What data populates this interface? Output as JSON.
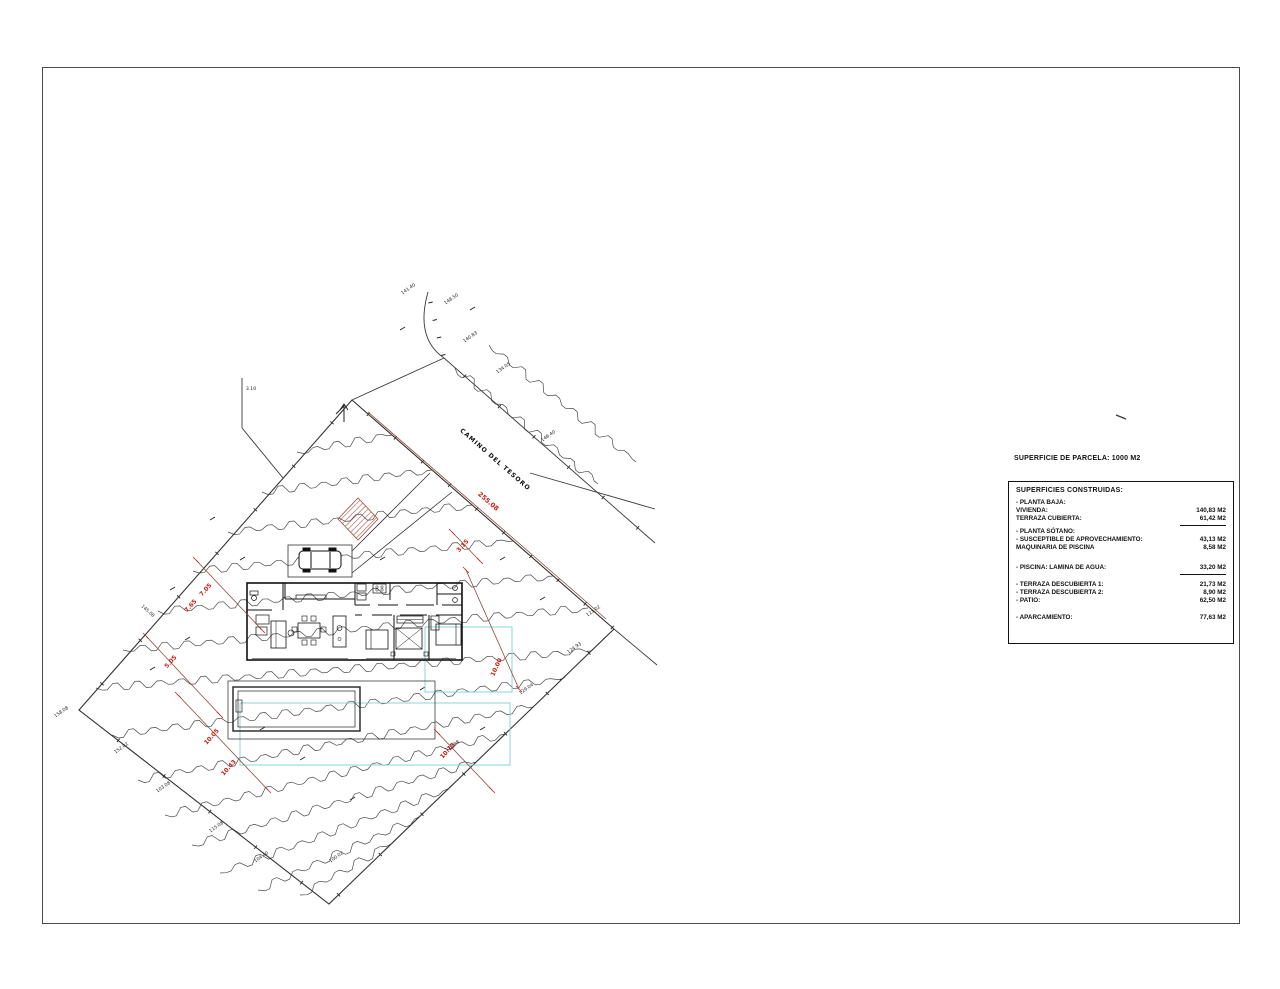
{
  "sheet": {
    "parcel_title": "SUPERFICIE DE PARCELA: 1000 M2",
    "table": {
      "heading": "SUPERFICIES CONSTRUIDAS:",
      "rows": [
        {
          "label": "- PLANTA BAJA:",
          "value": ""
        },
        {
          "label": "VIVIENDA:",
          "value": "140,83 M2"
        },
        {
          "label": "TERRAZA CUBIERTA:",
          "value": "61,42 M2"
        },
        {
          "label": "- PLANTA SÓTANO:",
          "value": ""
        },
        {
          "label": "- SUSCEPTIBLE DE APROVECHAMIENTO:",
          "value": "43,13 M2"
        },
        {
          "label": "MAQUINARIA DE PISCINA",
          "value": "8,58 M2"
        },
        {
          "label": "- PISCINA: LAMINA DE AGUA:",
          "value": "33,20 M2"
        },
        {
          "label": "- TERRAZA DESCUBIERTA 1:",
          "value": "21,73 M2"
        },
        {
          "label": "- TERRAZA DESCUBIERTA 2:",
          "value": "8,90 M2"
        },
        {
          "label": "- PATIO:",
          "value": "62,50 M2"
        },
        {
          "label": "- APARCAMIENTO:",
          "value": "77,63 M2"
        }
      ]
    }
  },
  "plan": {
    "road_label": "CAMINO DEL TESORO",
    "road_dimension": "255.08",
    "red_dimensions": [
      "7.65",
      "7.05",
      "5.05",
      "10.05",
      "10.43",
      "3.15",
      "10.00",
      "10.13"
    ],
    "survey_labels": [
      "141.40",
      "148.50",
      "140.83",
      "134.05",
      "146.40",
      "121.02",
      "124.93",
      "129.04",
      "128.88",
      "158.08",
      "152.02",
      "103.08",
      "115.08",
      "104.40",
      "100.02",
      "145.08",
      "3.10"
    ],
    "colors": {
      "line": "#3a3a3a",
      "red_text": "#c81e14",
      "dim_line": "#8b4a3a",
      "hatch": "#9e4b3b",
      "cyan": "#7fd0d8"
    }
  }
}
